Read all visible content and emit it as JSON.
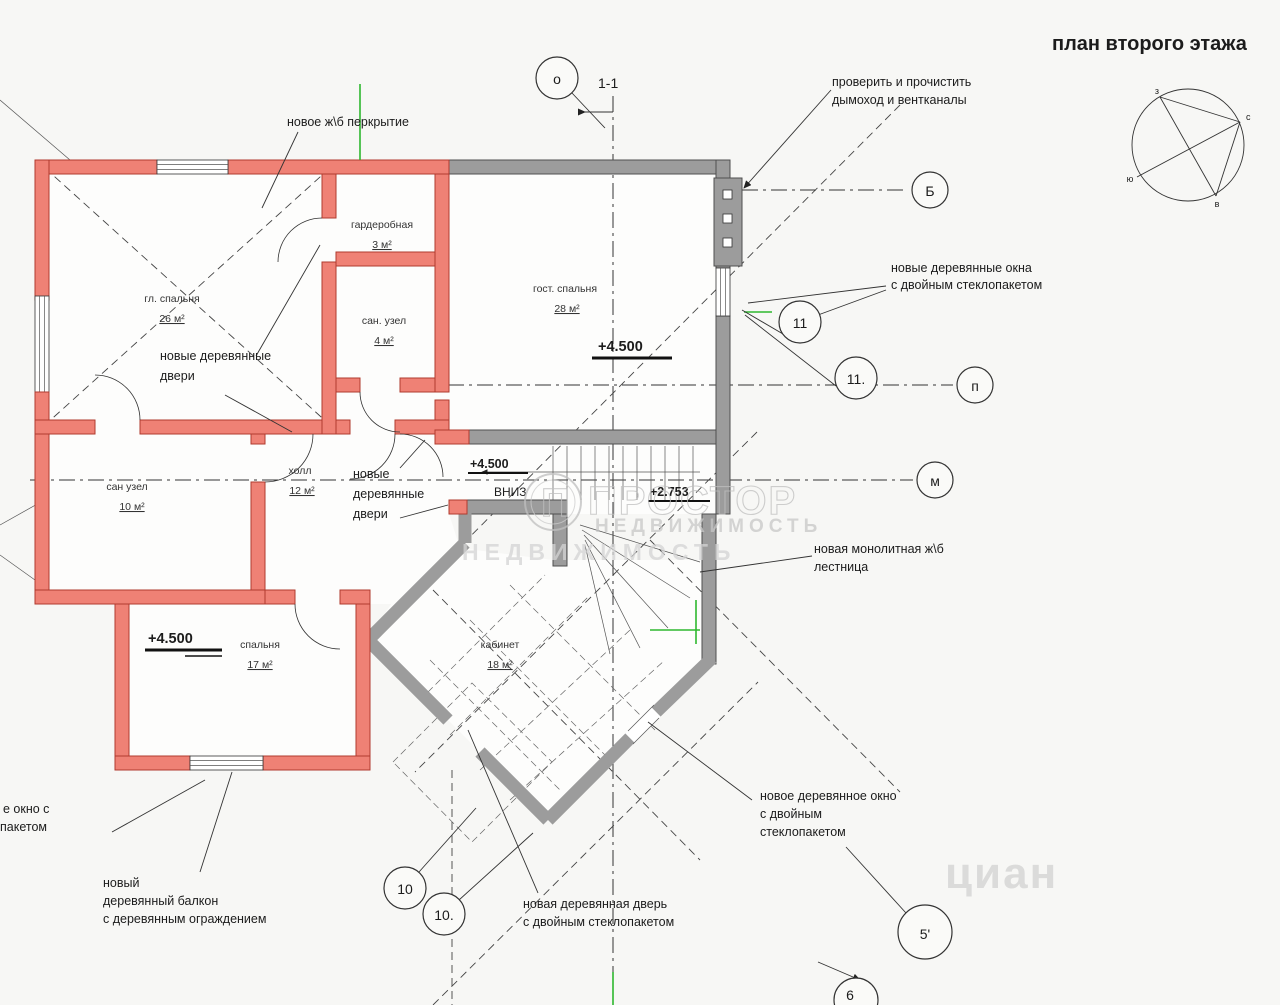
{
  "title": "план второго этажа",
  "annotations": {
    "slab": "новое ж\\б перкрытие",
    "chimney": [
      "проверить и прочистить",
      "дымоход и вентканалы"
    ],
    "windows_right": [
      "новые деревянные окна",
      "с двойным стеклопакетом"
    ],
    "doors_left": [
      "новые деревянные",
      "двери"
    ],
    "doors_center": [
      "новые",
      "деревянные",
      "двери"
    ],
    "stairs_note": [
      "новая монолитная ж\\б",
      "лестница"
    ],
    "window_bottom_right": [
      "новое деревянное окно",
      "с двойным",
      "стеклопакетом"
    ],
    "door_bottom": [
      "новая деревянная дверь",
      "с двойным стеклопакетом"
    ],
    "balcony": [
      "новый",
      "деревянный балкон",
      "с деревянным ограждением"
    ],
    "window_cut": [
      "е окно с",
      "пакетом"
    ]
  },
  "rooms": [
    {
      "name": "гл. спальня",
      "area": "26 м²"
    },
    {
      "name": "гардеробная",
      "area": "3 м²"
    },
    {
      "name": "сан. узел",
      "area": "4 м²"
    },
    {
      "name": "гост. спальня",
      "area": "28 м²"
    },
    {
      "name": "сан узел",
      "area": "10 м²"
    },
    {
      "name": "холл",
      "area": "12 м²"
    },
    {
      "name": "спальня",
      "area": "17 м²"
    },
    {
      "name": "кабинет",
      "area": "18 м²"
    }
  ],
  "elevations": {
    "guest": "+4.500",
    "hall": "+4.500",
    "bedroom": "+4.500",
    "stair": "+2.753"
  },
  "stair_down_label": "ВНИЗ",
  "section_label": "1-1",
  "markers": {
    "o": "о",
    "b": "Б",
    "p": "п",
    "m": "м",
    "n11": "11",
    "n11d": "11.",
    "n10": "10",
    "n10d": "10.",
    "n5": "5'",
    "n6": "6"
  },
  "compass": {
    "w": "з",
    "n": "с",
    "s": "ю",
    "e": "в"
  },
  "watermark": {
    "logo": "П",
    "brand": "ПРОСТОР",
    "sub": "НЕДВИЖИМОСТЬ",
    "sub2": "НЕДВИЖИМОСТЬ",
    "cian": "циан"
  },
  "colors": {
    "wall_red": "#ef8175",
    "wall_red_stroke": "#b03a2e",
    "wall_gray": "#9c9c9c",
    "accent_green": "#2eb82e",
    "line": "#333333",
    "watermark_gray": "#c7c7c7"
  }
}
